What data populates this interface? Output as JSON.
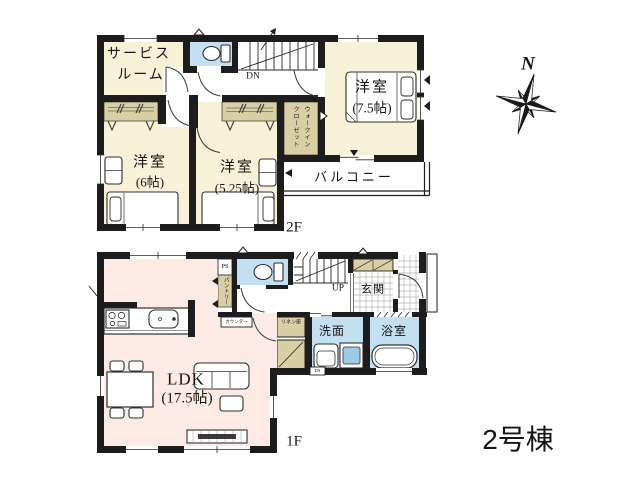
{
  "title": {
    "building": "2号棟"
  },
  "compass": {
    "north": "N"
  },
  "f2": {
    "label": "2F",
    "service1": "サービス",
    "service2": "ルーム",
    "r6_name": "洋室",
    "r6_size": "(6帖)",
    "r525_name": "洋室",
    "r525_size": "(5.25帖)",
    "r75_name": "洋室",
    "r75_size": "(7.5帖)",
    "wic1": "ウォークイン",
    "wic2": "クローゼット",
    "balcony": "バルコニー",
    "dn": "DN"
  },
  "f1": {
    "label": "1F",
    "ldk_name": "LDK",
    "ldk_size": "(17.5帖)",
    "genkan": "玄関",
    "up": "UP",
    "senmen": "洗面",
    "yokushitsu": "浴室",
    "linen": "リネン庫",
    "pantry": "パントリー",
    "counter": "カウンター",
    "ps": "PS",
    "ds": "DS"
  },
  "colors": {
    "wall": "#1d1d1d",
    "room_cream": "#f7f1d8",
    "closet_beige": "#d9cfa5",
    "water_blue": "#c3e0f2",
    "ldk_pink": "#fcebe4"
  }
}
